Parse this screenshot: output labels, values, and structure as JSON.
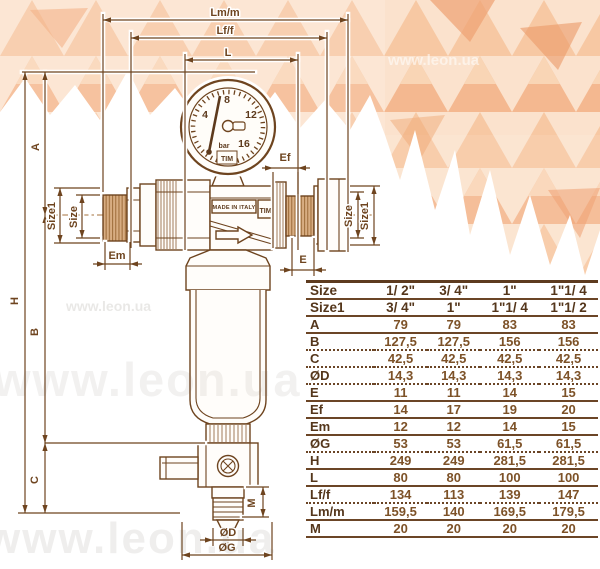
{
  "watermark": {
    "text": "www.leon.ua"
  },
  "drawing": {
    "labels": {
      "lmm": "Lm/m",
      "lff": "Lf/f",
      "l": "L",
      "h": "H",
      "a": "A",
      "b": "B",
      "c": "C",
      "size": "Size",
      "size1": "Size1",
      "em": "Em",
      "e": "E",
      "ef": "Ef",
      "m": "M",
      "od": "ØD",
      "og": "ØG"
    },
    "gauge": {
      "ticks": [
        "4",
        "8",
        "12",
        "16"
      ],
      "unit": "bar",
      "brand": "TIM"
    },
    "body": {
      "made_in": "MADE IN ITALY",
      "brand": "TIM"
    }
  },
  "table": {
    "rows": [
      {
        "label": "Size",
        "values": [
          "1/ 2\"",
          "3/ 4\"",
          "1\"",
          "1\"1/ 4"
        ]
      },
      {
        "label": "Size1",
        "values": [
          "3/ 4\"",
          "1\"",
          "1\"1/ 4",
          "1\"1/ 2"
        ]
      },
      {
        "label": "A",
        "values": [
          "79",
          "79",
          "83",
          "83"
        ]
      },
      {
        "label": "B",
        "values": [
          "127,5",
          "127,5",
          "156",
          "156"
        ]
      },
      {
        "label": "C",
        "values": [
          "42,5",
          "42,5",
          "42,5",
          "42,5"
        ]
      },
      {
        "label": "ØD",
        "values": [
          "14,3",
          "14,3",
          "14,3",
          "14,3"
        ]
      },
      {
        "label": "E",
        "values": [
          "11",
          "11",
          "14",
          "15"
        ]
      },
      {
        "label": "Ef",
        "values": [
          "14",
          "17",
          "19",
          "20"
        ]
      },
      {
        "label": "Em",
        "values": [
          "12",
          "12",
          "14",
          "15"
        ]
      },
      {
        "label": "ØG",
        "values": [
          "53",
          "53",
          "61,5",
          "61,5"
        ]
      },
      {
        "label": "H",
        "values": [
          "249",
          "249",
          "281,5",
          "281,5"
        ]
      },
      {
        "label": "L",
        "values": [
          "80",
          "80",
          "100",
          "100"
        ]
      },
      {
        "label": "Lf/f",
        "values": [
          "134",
          "113",
          "139",
          "147"
        ]
      },
      {
        "label": "Lm/m",
        "values": [
          "159,5",
          "140",
          "169,5",
          "179,5"
        ]
      },
      {
        "label": "M",
        "values": [
          "20",
          "20",
          "20",
          "20"
        ]
      }
    ]
  },
  "colors": {
    "ink": "#6e441f",
    "thread_fill": "#d8ad82",
    "table_line": "#6b4526",
    "pattern_peach_1": "#fbe2cc",
    "pattern_peach_2": "#f7c7a2",
    "pattern_peach_3": "#f4b78e",
    "pattern_accent": "#eea172"
  }
}
